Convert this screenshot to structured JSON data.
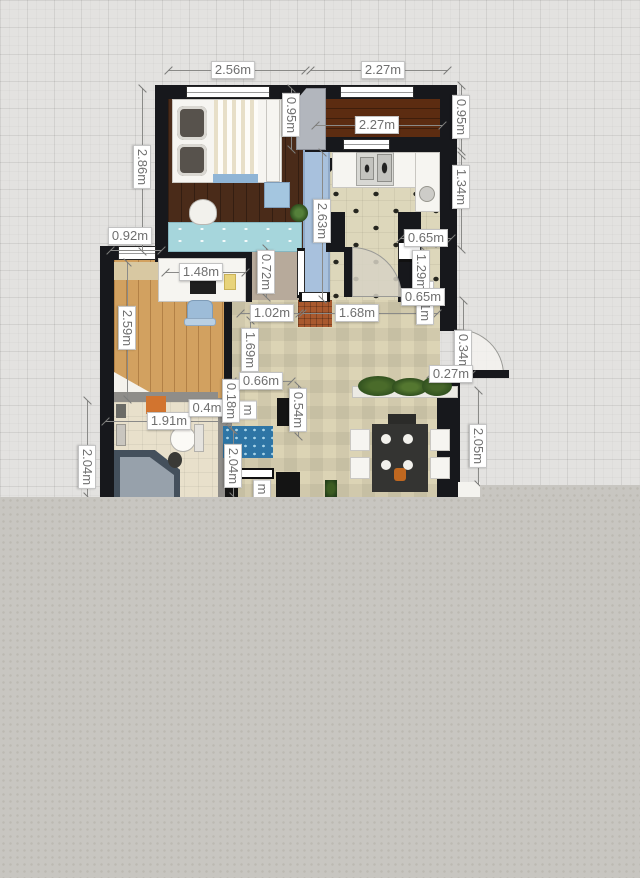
{
  "canvas": {
    "unit": "m",
    "grid_background": "#e3e2e0",
    "grid_line": "#d5d4d2",
    "blank_panel_color": "#c8c6c1",
    "wall_color": "#17181c",
    "label_text_color": "#6f6f6f",
    "label_background": "#ffffff"
  },
  "palette": {
    "bedroom_floor": "#4a2b19",
    "balcony_floor": "#5c2c11",
    "office_floor": "#d2a160",
    "kitchen_tile": "#ddd7bb",
    "living_tile": "#dcd4b5",
    "bathroom_tile": "#e8e0cb",
    "hallway_blue": "#a8c1dd",
    "doormat_rust": "#a9592e",
    "rug_blue": "#2e75a5",
    "desk_teal": "#a6d6dc",
    "chair_blue": "#9dbcd8",
    "shower_gray": "#44505c",
    "plant_green": "#3c5c22",
    "accent_orange": "#d2742f"
  },
  "dimension_labels": [
    {
      "t": "2.56m",
      "x": 233,
      "y": 70
    },
    {
      "t": "2.27m",
      "x": 383,
      "y": 70
    },
    {
      "t": "2.27m",
      "x": 377,
      "y": 125
    },
    {
      "t": "0.92m",
      "x": 130,
      "y": 236
    },
    {
      "t": "0.65m",
      "x": 426,
      "y": 238,
      "z": 12
    },
    {
      "t": "0.65m",
      "x": 423,
      "y": 297,
      "z": 12
    },
    {
      "t": "1.48m",
      "x": 201,
      "y": 272
    },
    {
      "t": "1.02m",
      "x": 272,
      "y": 313
    },
    {
      "t": "1.68m",
      "x": 357,
      "y": 313
    },
    {
      "t": "0.66m",
      "x": 261,
      "y": 381,
      "z": 12
    },
    {
      "t": "0.4m",
      "x": 207,
      "y": 408,
      "z": 8
    },
    {
      "t": "1.91m",
      "x": 169,
      "y": 421
    },
    {
      "t": "0.27m",
      "x": 451,
      "y": 374,
      "z": 12
    },
    {
      "t": "0.95m",
      "x": 291,
      "y": 115,
      "v": 1
    },
    {
      "t": "2.86m",
      "x": 142,
      "y": 167,
      "v": 1
    },
    {
      "t": "0.95m",
      "x": 461,
      "y": 117,
      "v": 1
    },
    {
      "t": "1.34m",
      "x": 461,
      "y": 187,
      "v": 1
    },
    {
      "t": "2.63m",
      "x": 322,
      "y": 221,
      "v": 1
    },
    {
      "t": "1.29m",
      "x": 421,
      "y": 272,
      "v": 1,
      "z": 9
    },
    {
      "t": "0.31m",
      "x": 425,
      "y": 303,
      "v": 1,
      "z": 8
    },
    {
      "t": "0.34m",
      "x": 463,
      "y": 352,
      "v": 1,
      "z": 9
    },
    {
      "t": "0.72m",
      "x": 266,
      "y": 272,
      "v": 1
    },
    {
      "t": "2.59m",
      "x": 127,
      "y": 328,
      "v": 1
    },
    {
      "t": "1.69m",
      "x": 250,
      "y": 350,
      "v": 1
    },
    {
      "t": "0.18m",
      "x": 231,
      "y": 401,
      "v": 1,
      "z": 11
    },
    {
      "t": "m",
      "x": 248,
      "y": 410,
      "v": 1,
      "z": 8
    },
    {
      "t": "0.54m",
      "x": 298,
      "y": 410,
      "v": 1
    },
    {
      "t": "2.04m",
      "x": 87,
      "y": 467,
      "v": 1
    },
    {
      "t": "2.04m",
      "x": 233,
      "y": 466,
      "v": 1
    },
    {
      "t": "2.05m",
      "x": 478,
      "y": 446,
      "v": 1
    },
    {
      "t": "m",
      "x": 262,
      "y": 489,
      "v": 1,
      "z": 8
    }
  ],
  "dimension_lines": [
    {
      "x1": 168,
      "y1": 70,
      "x2": 306,
      "y2": 70
    },
    {
      "x1": 310,
      "y1": 70,
      "x2": 448,
      "y2": 70
    },
    {
      "x1": 315,
      "y1": 125,
      "x2": 443,
      "y2": 125
    },
    {
      "x1": 110,
      "y1": 250,
      "x2": 162,
      "y2": 250
    },
    {
      "x1": 165,
      "y1": 272,
      "x2": 246,
      "y2": 272
    },
    {
      "x1": 240,
      "y1": 313,
      "x2": 300,
      "y2": 313
    },
    {
      "x1": 302,
      "y1": 313,
      "x2": 438,
      "y2": 313
    },
    {
      "x1": 232,
      "y1": 381,
      "x2": 292,
      "y2": 381
    },
    {
      "x1": 105,
      "y1": 421,
      "x2": 230,
      "y2": 421
    },
    {
      "x1": 430,
      "y1": 374,
      "x2": 472,
      "y2": 374
    },
    {
      "x1": 400,
      "y1": 238,
      "x2": 452,
      "y2": 238
    },
    {
      "x1": 142,
      "y1": 88,
      "x2": 142,
      "y2": 252
    },
    {
      "x1": 291,
      "y1": 88,
      "x2": 291,
      "y2": 150
    },
    {
      "x1": 461,
      "y1": 85,
      "x2": 461,
      "y2": 152
    },
    {
      "x1": 461,
      "y1": 155,
      "x2": 461,
      "y2": 250
    },
    {
      "x1": 322,
      "y1": 152,
      "x2": 322,
      "y2": 300
    },
    {
      "x1": 266,
      "y1": 248,
      "x2": 266,
      "y2": 298
    },
    {
      "x1": 127,
      "y1": 262,
      "x2": 127,
      "y2": 400
    },
    {
      "x1": 250,
      "y1": 320,
      "x2": 250,
      "y2": 380
    },
    {
      "x1": 231,
      "y1": 385,
      "x2": 231,
      "y2": 430
    },
    {
      "x1": 298,
      "y1": 385,
      "x2": 298,
      "y2": 437
    },
    {
      "x1": 87,
      "y1": 400,
      "x2": 87,
      "y2": 497
    },
    {
      "x1": 233,
      "y1": 430,
      "x2": 233,
      "y2": 497
    },
    {
      "x1": 478,
      "y1": 390,
      "x2": 478,
      "y2": 485
    },
    {
      "x1": 463,
      "y1": 300,
      "x2": 463,
      "y2": 374
    },
    {
      "x1": 421,
      "y1": 247,
      "x2": 421,
      "y2": 298
    }
  ]
}
